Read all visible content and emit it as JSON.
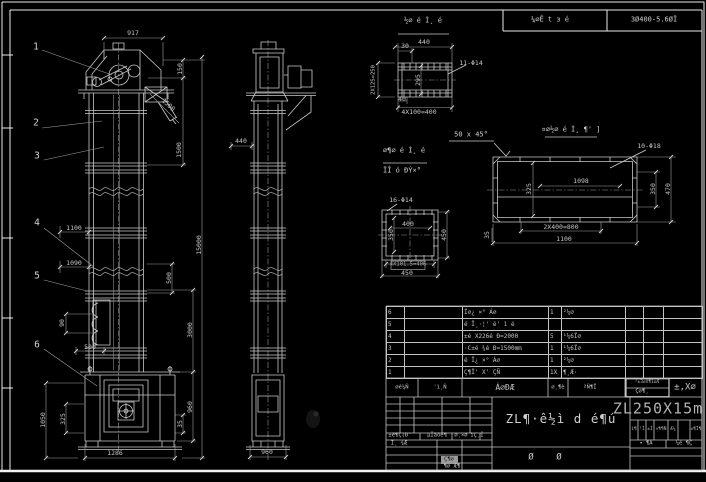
{
  "app": {
    "type": "cad-drawing",
    "model_tag": "ZL250X15m"
  },
  "colors": {
    "background": "#000000",
    "line": "#c9c9c9",
    "bright": "#eaeaea",
    "text": "#c6c6c6",
    "grey_fill": "#9a9a9a"
  },
  "top_bar": {
    "cell_left": "¼∅Ê t з é",
    "cell_right": "3Ø400-5.6ØÏ"
  },
  "balloons": [
    "1",
    "2",
    "3",
    "4",
    "5",
    "6"
  ],
  "front": {
    "dims": {
      "w917": "917",
      "h150": "150",
      "d1500": "1500",
      "h1500": "1500",
      "h15000": "15000",
      "w1100": "1100",
      "w1090": "1090",
      "p500": "500",
      "h90": "90",
      "w500": "500",
      "h1050": "1050",
      "h325": "325",
      "w1286": "1286",
      "h3000": "3000",
      "h960": "960",
      "h35": "35"
    }
  },
  "side": {
    "dims": {
      "w440": "440",
      "w960": "960"
    }
  },
  "detail_a": {
    "title": "½∅ é Ì¸ é",
    "dim_440": "440",
    "dim_30": "30",
    "holes": "11-Φ14",
    "dim_left": "2X125=250",
    "dim_295": "295",
    "dim_40": "40",
    "dim_pitch": "4X100=400"
  },
  "notes": {
    "chamfer": "50 x 45°",
    "cap_line1": "∅¶∅ é Ì¸ é",
    "cap_line2": "ÏÎ ó ÐÝ×°",
    "detail_b_title": "¤∅½∅ é Ì¸ ¶' ]"
  },
  "detail_b": {
    "holes": "10-Φ18",
    "dim_1098": "1098",
    "dim_325": "325",
    "dim_350": "350",
    "dim_470": "470",
    "dim_pitch": "2X400=800",
    "dim_1100": "1100",
    "dim_35": "35"
  },
  "detail_c": {
    "holes": "16-Φ14",
    "dim_400": "400",
    "dim_350": "350",
    "dim_450r": "450",
    "dim_pitch": "4X101.5=406",
    "dim_450b": "450"
  },
  "bom": {
    "rows": [
      {
        "no": "6",
        "code": "",
        "name": "Ï∅¿ ×° Á∅",
        "qty": "1",
        "mat": "²¼∅",
        "c6": "",
        "c7": "",
        "c8": ""
      },
      {
        "no": "5",
        "code": "",
        "name": "é Ï¸·¦' é' ì é",
        "qty": "",
        "mat": "",
        "c6": "",
        "c7": "",
        "c8": ""
      },
      {
        "no": "4",
        "code": "",
        "name": "±é X226é Ð=2000",
        "qty": "5",
        "mat": "¹¼6Ï∅",
        "c6": "",
        "c7": "",
        "c8": ""
      },
      {
        "no": "3",
        "code": "",
        "name": "·C±é ¾é Ð=1500mm",
        "qty": "1",
        "mat": "¹¼6Ï∅",
        "c6": "",
        "c7": "",
        "c8": ""
      },
      {
        "no": "2",
        "code": "",
        "name": "é Ï¿ ×° Á∅",
        "qty": "1",
        "mat": "²¼∅",
        "c6": "",
        "c7": "",
        "c8": ""
      },
      {
        "no": "1",
        "code": "",
        "name": "Ç¶Ï' X' ÇÑ",
        "qty": "1X",
        "mat": "¶¸Æ·",
        "c6": "",
        "c7": "",
        "c8": ""
      }
    ],
    "header": {
      "no": "∅é¼Ñ",
      "code": "'ì¸Ñ",
      "name": "Á∅ÐÆ",
      "qty": "∅¸¶è",
      "mat": "ªÑ¶Ï",
      "box_top": "²±3∅X¶1∅Æ",
      "box_bottom": "Ç∅¶¸",
      "remark": "±,X∅"
    }
  },
  "title_block": {
    "model": "ZL250X15m",
    "title": "ZL¶·ê½ì d é¶ú",
    "char_left": "Ø",
    "char_right": "Ø",
    "sig_row": {
      "c1": "±é¶Ç(Ð'",
      "c2": "µÏàòé¶",
      "c3": "∅¸×∅",
      "c4": "ìÇ¸Ï"
    },
    "sig2": "Ï¸ ¾Æ",
    "grey_cell": "Ç¶∅",
    "bottom_left": "¶∅ Æ¶",
    "mini": {
      "m1": "ì¶",
      "m2": "¹Ì",
      "m3": "±Ì",
      "m4": "×¶¶Ñ",
      "m5": "Æ¼",
      "m6": "±¶Ï¶",
      "r1": "• ¶Á",
      "r2": "¼é ¶Ç"
    }
  }
}
